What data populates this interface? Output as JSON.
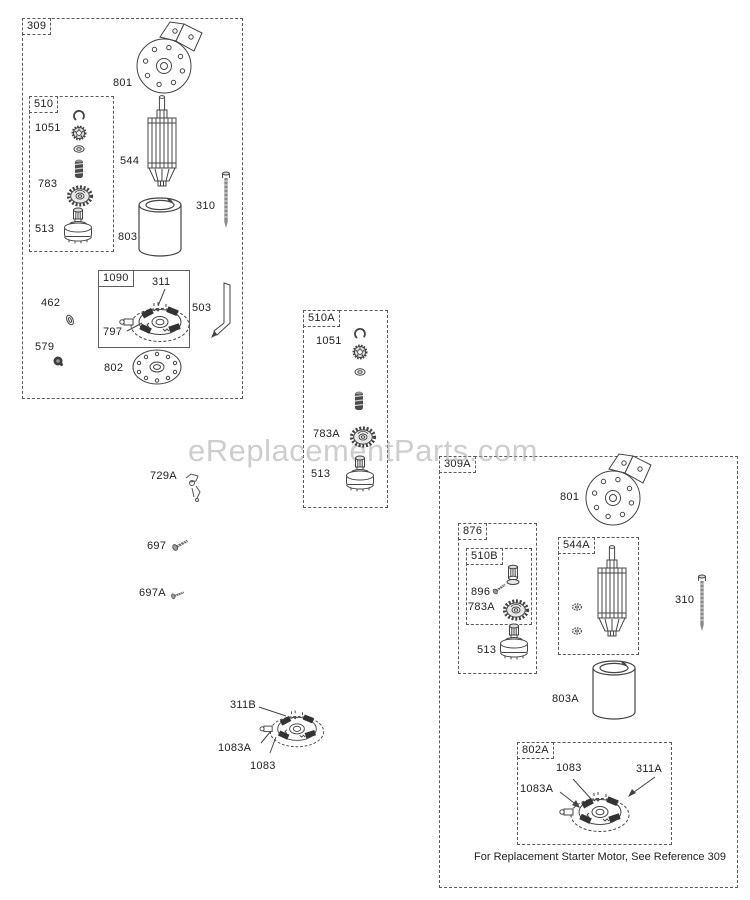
{
  "watermark": {
    "text": "eReplacementParts.com"
  },
  "footer": {
    "note": "For Replacement Starter Motor, See Reference 309"
  },
  "boxes": {
    "b309": "309",
    "b510": "510",
    "b1090": "1090",
    "b510A": "510A",
    "b309A": "309A",
    "b876": "876",
    "b510B": "510B",
    "b544A": "544A",
    "b802A": "802A"
  },
  "labels": {
    "g309": {
      "p801": "801",
      "p544": "544",
      "p310": "310",
      "p803": "803",
      "p1051": "1051",
      "p783": "783",
      "p513": "513",
      "p311": "311",
      "p797": "797",
      "p462": "462",
      "p503": "503",
      "p579": "579",
      "p802": "802"
    },
    "g510A": {
      "p1051": "1051",
      "p783A": "783A",
      "p513": "513"
    },
    "loose": {
      "p729A": "729A",
      "p697": "697",
      "p697A": "697A",
      "p311B": "311B",
      "p1083A": "1083A",
      "p1083": "1083"
    },
    "g309A": {
      "p801": "801",
      "p896": "896",
      "p783A": "783A",
      "p513": "513",
      "p310": "310",
      "p803A": "803A",
      "p1083": "1083",
      "p311A": "311A",
      "p1083A": "1083A"
    }
  }
}
